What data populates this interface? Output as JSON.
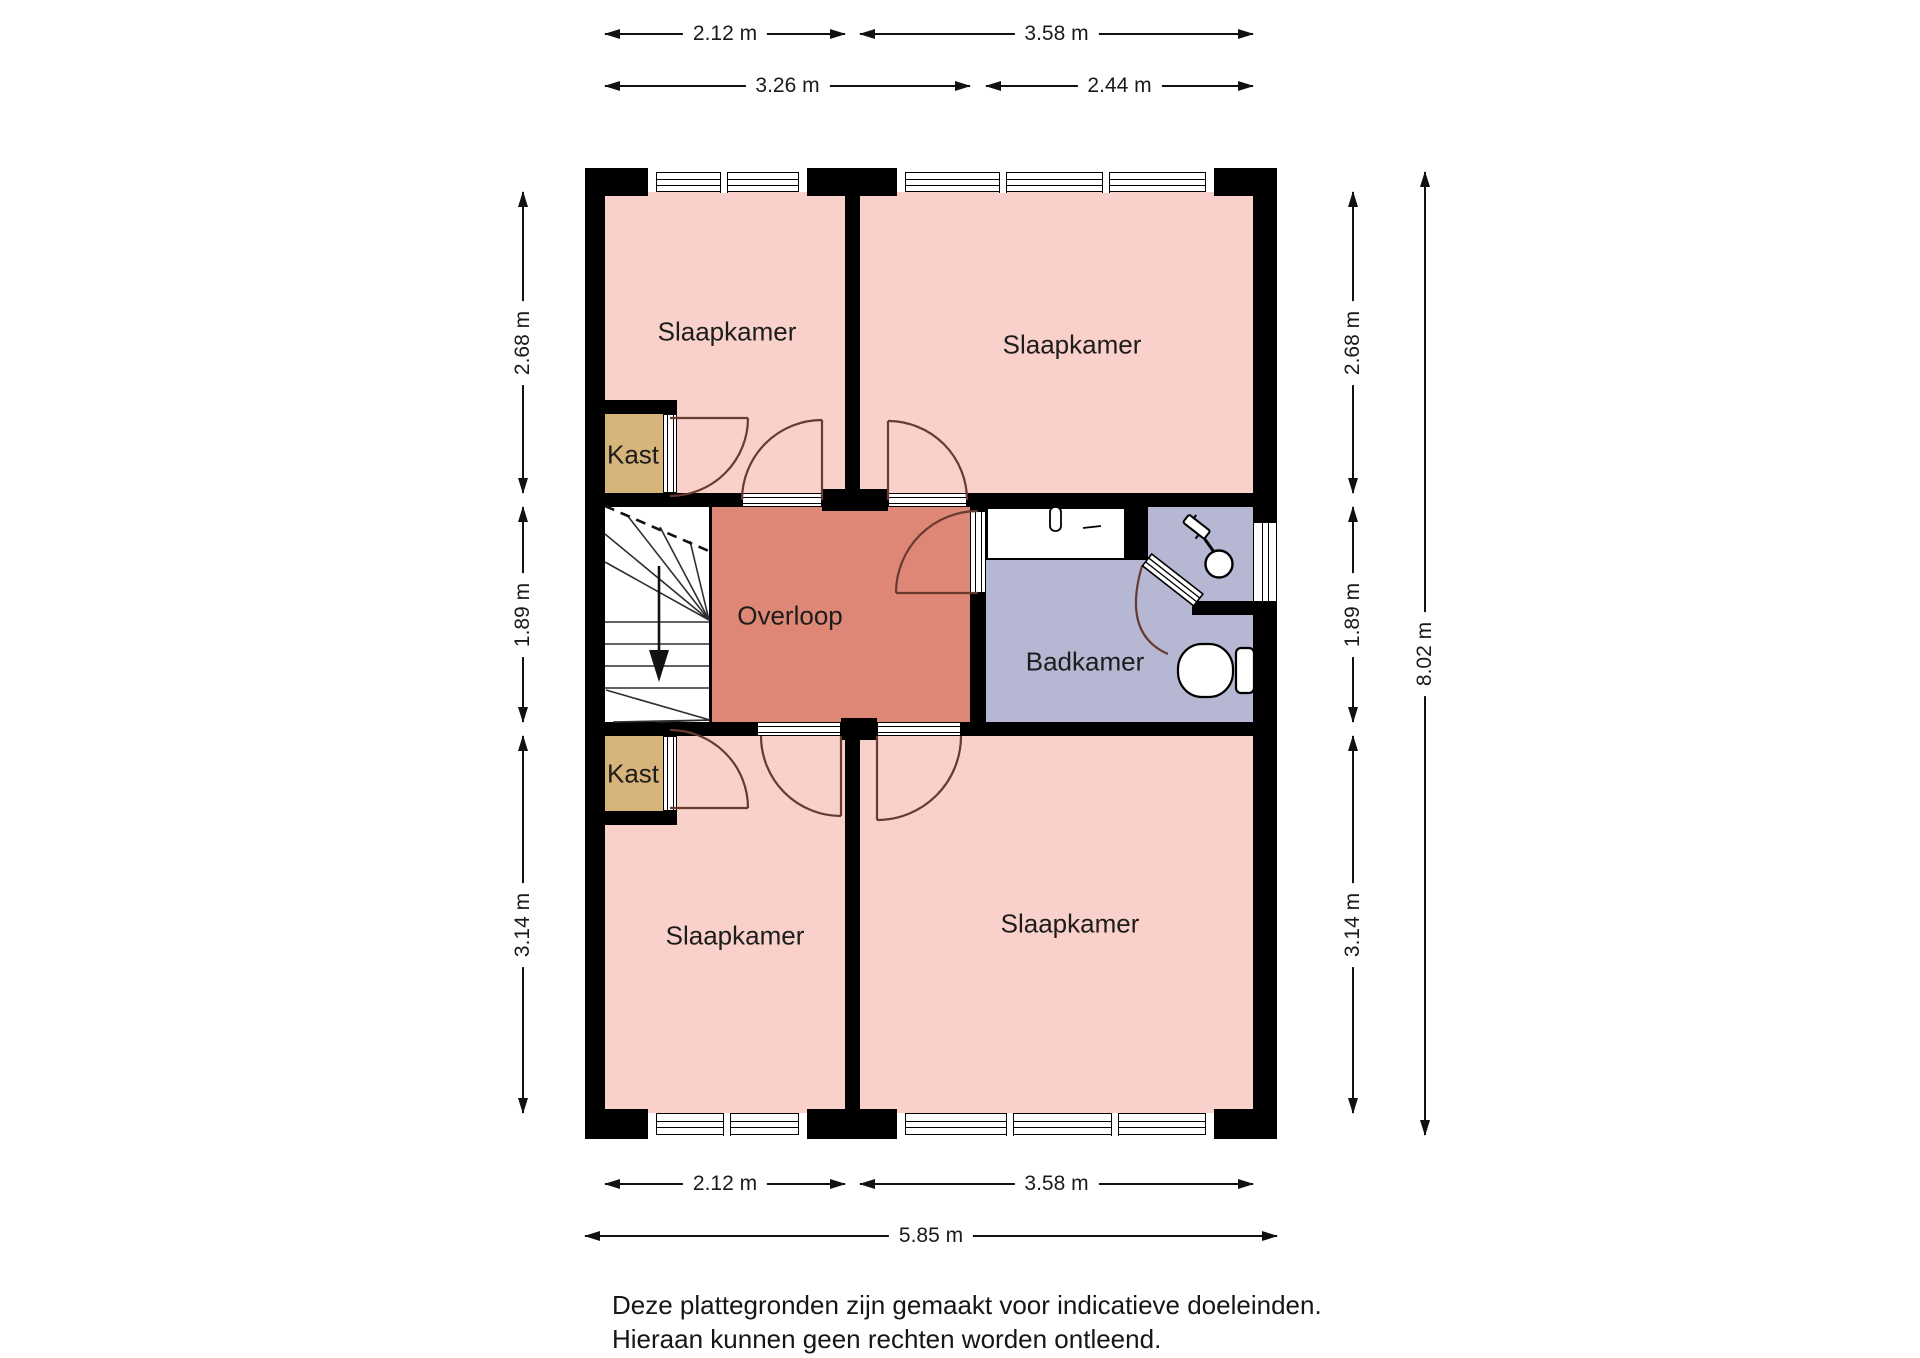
{
  "rooms": {
    "bedroom_top_left": "Slaapkamer",
    "bedroom_top_right": "Slaapkamer",
    "bedroom_bottom_left": "Slaapkamer",
    "bedroom_bottom_right": "Slaapkamer",
    "closet_top": "Kast",
    "closet_bottom": "Kast",
    "landing": "Overloop",
    "bathroom": "Badkamer"
  },
  "dims": {
    "top1_left": "2.12 m",
    "top1_right": "3.58 m",
    "top2_left": "3.26 m",
    "top2_right": "2.44 m",
    "left_top": "2.68 m",
    "left_mid": "1.89 m",
    "left_bottom": "3.14 m",
    "right_top": "2.68 m",
    "right_mid": "1.89 m",
    "right_bottom": "3.14 m",
    "right_total": "8.02 m",
    "bottom1_left": "2.12 m",
    "bottom1_right": "3.58 m",
    "bottom2_total": "5.85 m"
  },
  "footer": {
    "line1": "Deze plattegronden zijn gemaakt voor indicatieve doeleinden.",
    "line2": "Hieraan kunnen geen rechten worden ontleend."
  },
  "colors": {
    "bedroom_fill": "#f9d1ca",
    "landing_fill": "#df8777",
    "bathroom_fill": "#b6b7d2",
    "closet_fill": "#d6b47a",
    "wall": "#000000",
    "door_arc": "#683a30"
  }
}
